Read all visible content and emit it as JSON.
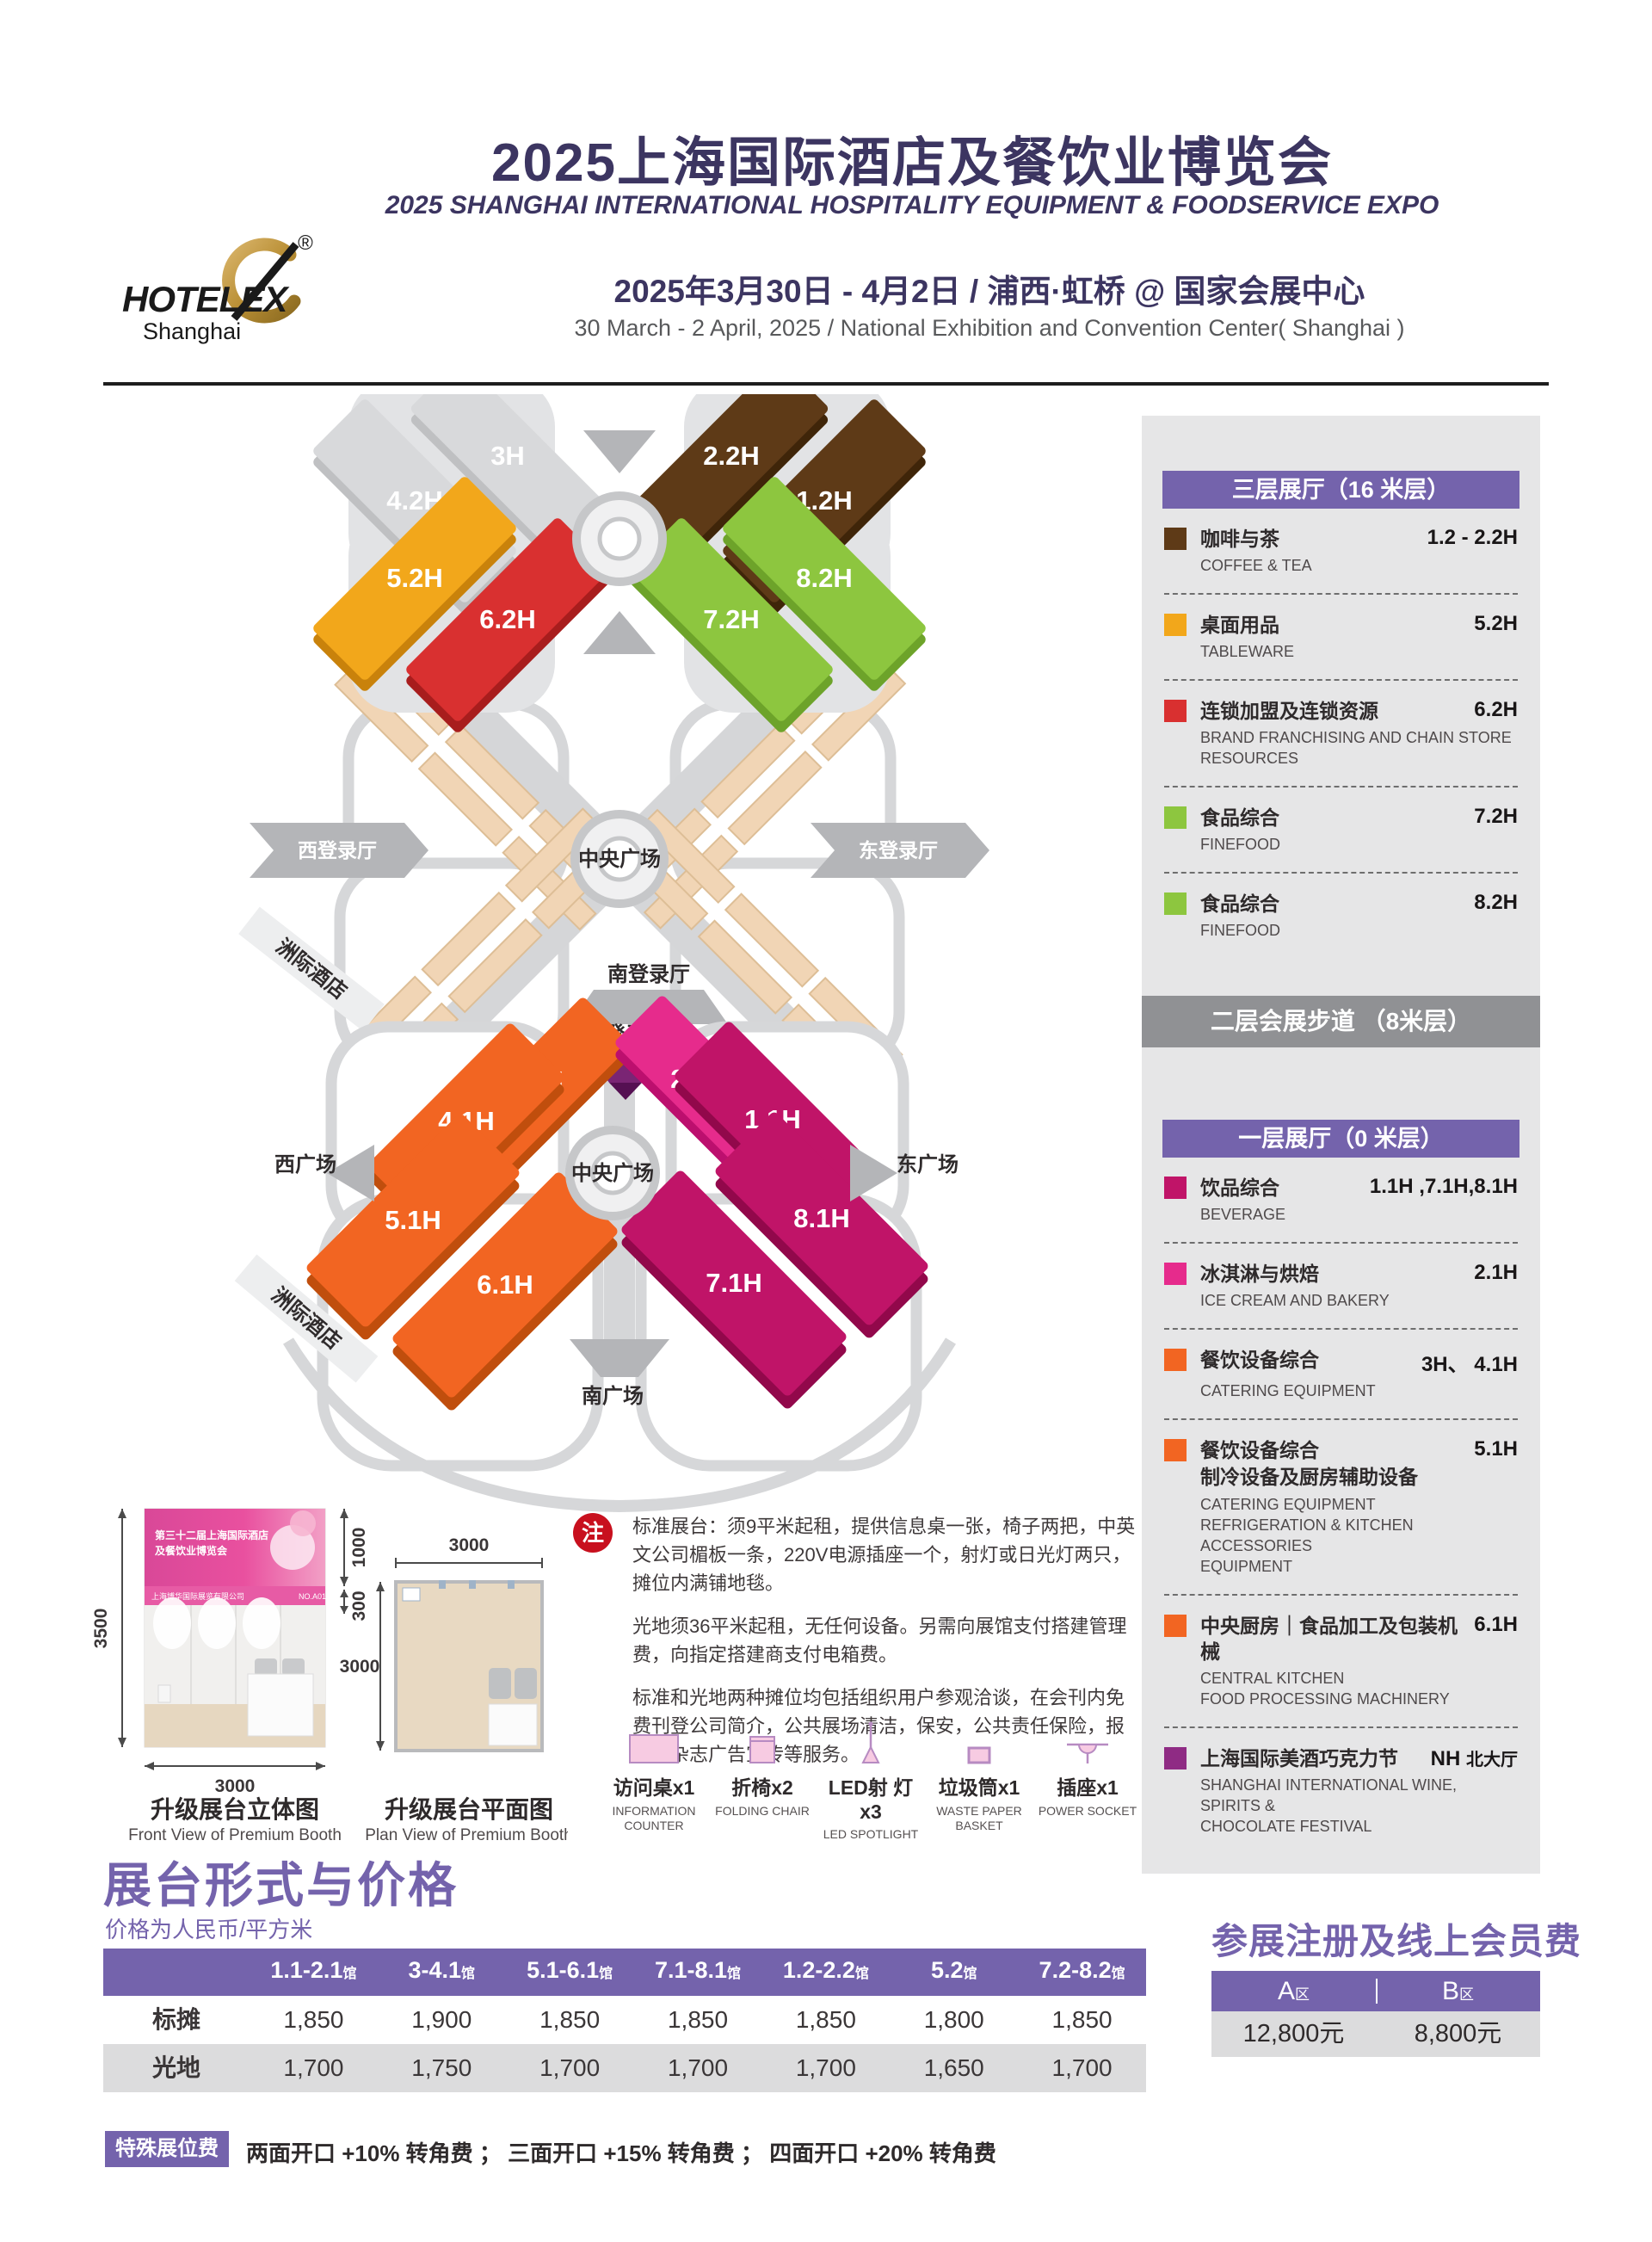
{
  "colors": {
    "purple": "#7463AC",
    "brown": "#5E3A17",
    "yellow": "#F2A71B",
    "red": "#D93030",
    "green": "#8DC63F",
    "orange": "#F26522",
    "pink": "#E62B8C",
    "magenta": "#C01468",
    "wine_purple": "#8F2B84",
    "hall_gray": "#D8D9DB"
  },
  "header": {
    "title_cn": "2025上海国际酒店及餐饮业博览会",
    "title_en": "2025 SHANGHAI INTERNATIONAL HOSPITALITY EQUIPMENT & FOODSERVICE EXPO",
    "date_cn": "2025年3月30日 - 4月2日 / 浦西·虹桥 @ 国家会展中心",
    "date_en": "30 March - 2 April, 2025 / National Exhibition and Convention Center( Shanghai )",
    "logo_word": "HOTELEX",
    "logo_sub": "Shanghai",
    "logo_reg": "®"
  },
  "map": {
    "floor3_halls": {
      "h3": "3H",
      "h42": "4.2H",
      "h22": "2.2H",
      "h12": "1.2H",
      "h52": "5.2H",
      "h62": "6.2H",
      "h82": "8.2H",
      "h72": "7.2H"
    },
    "floor2_labels": {
      "west": "西登录厅",
      "center": "中央广场",
      "east": "东登录厅",
      "south": "南登录厅",
      "hotel": "洲际酒店"
    },
    "floor1_halls": {
      "h3": "3H",
      "h41": "4.1H",
      "h21": "2.1H",
      "h11": "1.1H",
      "h51": "5.1H",
      "h61": "6.1H",
      "h81": "8.1H",
      "h71": "7.1H"
    },
    "floor1_labels": {
      "north": "北登录厅",
      "west": "西广场",
      "center": "中央广场",
      "east": "东广场",
      "south": "南广场",
      "hotel": "洲际酒店"
    }
  },
  "legend": {
    "floor3_title": "三层展厅（16 米层）",
    "floor2_title": "二层会展步道 （8米层）",
    "floor1_title": "一层展厅（0 米层）",
    "floor3_items": [
      {
        "color": "#5E3A17",
        "cn": "咖啡与茶",
        "en": "COFFEE & TEA",
        "hall": "1.2 - 2.2H"
      },
      {
        "color": "#F2A71B",
        "cn": "桌面用品",
        "en": "TABLEWARE",
        "hall": "5.2H"
      },
      {
        "color": "#D93030",
        "cn": "连锁加盟及连锁资源",
        "en": "BRAND FRANCHISING AND CHAIN STORE RESOURCES",
        "hall": "6.2H"
      },
      {
        "color": "#8DC63F",
        "cn": "食品综合",
        "en": "FINEFOOD",
        "hall": "7.2H"
      },
      {
        "color": "#8DC63F",
        "cn": "食品综合",
        "en": "FINEFOOD",
        "hall": "8.2H"
      }
    ],
    "floor1_items": [
      {
        "color": "#C01468",
        "cn": "饮品综合",
        "en": "BEVERAGE",
        "hall": "1.1H ,7.1H,8.1H"
      },
      {
        "color": "#E62B8C",
        "cn": "冰淇淋与烘焙",
        "en": "ICE CREAM AND BAKERY",
        "hall": "2.1H"
      },
      {
        "color": "#F26522",
        "cn": "餐饮设备综合",
        "en": "CATERING EQUIPMENT",
        "hall": "3H、 4.1H"
      },
      {
        "color": "#F26522",
        "cn": "餐饮设备综合",
        "cn2": "制冷设备及厨房辅助设备",
        "en": "CATERING EQUIPMENT\nREFRIGERATION & KITCHEN ACCESSORIES\nEQUIPMENT",
        "hall": "5.1H"
      },
      {
        "color": "#F26522",
        "cn": "中央厨房｜食品加工及包装机械",
        "en": "CENTRAL KITCHEN\nFOOD PROCESSING MACHINERY",
        "hall": "6.1H"
      },
      {
        "color": "#8F2B84",
        "cn": "上海国际美酒巧克力节",
        "en": "SHANGHAI INTERNATIONAL WINE, SPIRITS &\nCHOCOLATE FESTIVAL",
        "hall_code": "NH",
        "hall_note": "北大厅"
      }
    ]
  },
  "booth": {
    "front": {
      "cap_cn": "升级展台立体图",
      "cap_en": "Front View of Premium Booth",
      "dim_h": "3500",
      "dim_banner": "1000",
      "dim_strip": "300",
      "dim_w": "3000",
      "banner1": "第三十二届上海国际酒店",
      "banner2": "及餐饮业博览会",
      "strip_left": "上海博华国际展览有限公司",
      "strip_right": "NO.A01"
    },
    "plan": {
      "cap_cn": "升级展台平面图",
      "cap_en": "Plan View of Premium Booth",
      "dim_w": "3000",
      "dim_d": "3000"
    }
  },
  "note": {
    "badge": "注",
    "p1": "标准展台：须9平米起租，提供信息桌一张，椅子两把，中英文公司楣板一条，220V电源插座一个，射灯或日光灯两只，摊位内满铺地毯。",
    "p2": "光地须36平米起租，无任何设备。另需向展馆支付搭建管理费，向指定搭建商支付电箱费。",
    "p3": "标准和光地两种摊位均包括组织用户参观洽谈，在会刊内免费刊登公司简介，公共展场清洁，保安，公共责任保险，报刊，杂志广告宣传等服务。",
    "items": [
      {
        "cn": "访问桌x1",
        "en": "INFORMATION COUNTER"
      },
      {
        "cn": "折椅x2",
        "en": "FOLDING CHAIR"
      },
      {
        "cn": "LED射 灯x3",
        "en": "LED SPOTLIGHT"
      },
      {
        "cn": "垃圾筒x1",
        "en": "WASTE PAPER BASKET"
      },
      {
        "cn": "插座x1",
        "en": "POWER SOCKET"
      }
    ]
  },
  "pricing": {
    "title": "展台形式与价格",
    "subtitle": "价格为人民币/平方米",
    "cols": [
      {
        "num": "1.1-2.1",
        "suffix": "馆"
      },
      {
        "num": "3-4.1",
        "suffix": "馆"
      },
      {
        "num": "5.1-6.1",
        "suffix": "馆"
      },
      {
        "num": "7.1-8.1",
        "suffix": "馆"
      },
      {
        "num": "1.2-2.2",
        "suffix": "馆"
      },
      {
        "num": "5.2",
        "suffix": "馆"
      },
      {
        "num": "7.2-8.2",
        "suffix": "馆"
      }
    ],
    "rows": [
      {
        "label": "标摊",
        "values": [
          "1,850",
          "1,900",
          "1,850",
          "1,850",
          "1,850",
          "1,800",
          "1,850"
        ]
      },
      {
        "label": "光地",
        "values": [
          "1,700",
          "1,750",
          "1,700",
          "1,700",
          "1,700",
          "1,650",
          "1,700"
        ]
      }
    ],
    "special_badge": "特殊展位费",
    "special_text": "两面开口 +10% 转角费 ； 三面开口 +15% 转角费 ； 四面开口 +20% 转角费"
  },
  "registration": {
    "title": "参展注册及线上会员费",
    "col_a": "A",
    "col_a_suffix": "区",
    "col_b": "B",
    "col_b_suffix": "区",
    "val_a": "12,800元",
    "val_b": "8,800元"
  }
}
